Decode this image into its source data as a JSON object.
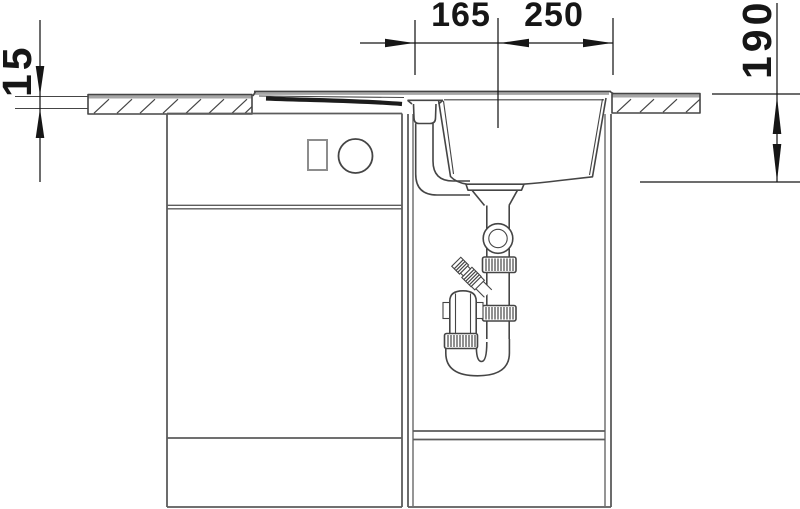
{
  "dimensions": {
    "countertop_thickness": "15",
    "center_to_left_reference": "165",
    "center_to_right_edge": "250",
    "basin_depth": "190"
  },
  "colors": {
    "ink": "#161616",
    "line": "#454545",
    "cab": "#5c5c5c",
    "cablight": "#8d8d8d",
    "bandgray": "#a6a6a6",
    "darkband": "#1c1c1c",
    "paper": "#ffffff"
  }
}
